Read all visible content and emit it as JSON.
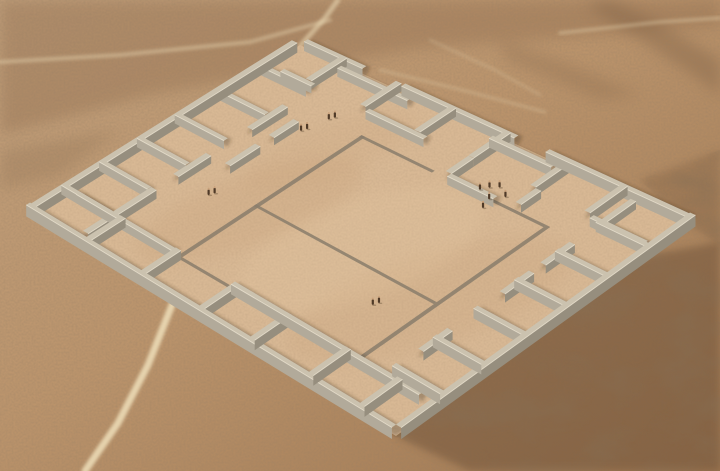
{
  "image": {
    "width": 720,
    "height": 471,
    "description": "Aerial 3D reconstruction of a large square walled archaeological compound (adobe enclosure) on a desert plain: perimeter rooms along all four sides, a flat-outlined central courtyard, tiny human figures for scale, and light foot tracks crossing the sand."
  },
  "colors": {
    "bg1": "#c2a17d",
    "bg2": "#bb946c",
    "bg3": "#9e7650",
    "topBand": "#8f6b4b",
    "rough": "#6e5137",
    "sand": "#d9b995",
    "sandShade": "#c19870",
    "sandLight": "#e8cca6",
    "path": "#efdfba",
    "wallTop": "#cbc2af",
    "wallLight": "#b2aa9a",
    "wallDark": "#968e7e",
    "wallHighlight": "#e9e1cf",
    "strip": "#8b7e6c",
    "shadow": "#3c2a18",
    "figure": "#4f3a28",
    "figureHead": "#caa27c"
  },
  "desert": {
    "top_band": [
      [
        0,
        0
      ],
      [
        720,
        0
      ],
      [
        720,
        26
      ],
      [
        420,
        48
      ],
      [
        150,
        95
      ],
      [
        0,
        135
      ]
    ],
    "rough_patches": [
      {
        "pts": [
          [
            720,
            242
          ],
          [
            622,
            260
          ],
          [
            520,
            300
          ],
          [
            430,
            390
          ],
          [
            396,
            436
          ],
          [
            470,
            471
          ],
          [
            720,
            471
          ]
        ],
        "opacity": 0.5
      },
      {
        "pts": [
          [
            720,
            150
          ],
          [
            640,
            180
          ],
          [
            688,
            224
          ],
          [
            720,
            245
          ]
        ],
        "opacity": 0.25
      }
    ],
    "streaks": [
      {
        "pts": [
          [
            585,
            5
          ],
          [
            640,
            40
          ],
          [
            700,
            80
          ],
          [
            720,
            95
          ],
          [
            720,
            60
          ],
          [
            655,
            20
          ],
          [
            610,
            0
          ]
        ],
        "opacity": 0.3
      },
      {
        "pts": [
          [
            500,
            40
          ],
          [
            560,
            60
          ],
          [
            640,
            95
          ],
          [
            600,
            100
          ],
          [
            505,
            60
          ]
        ],
        "opacity": 0.2
      },
      {
        "pts": [
          [
            0,
            150
          ],
          [
            120,
            130
          ],
          [
            60,
            175
          ],
          [
            0,
            190
          ]
        ],
        "opacity": 0.18
      }
    ],
    "tracks": [
      {
        "pts": [
          [
            85,
            471
          ],
          [
            118,
            423
          ],
          [
            148,
            365
          ],
          [
            172,
            305
          ],
          [
            192,
            262
          ]
        ],
        "w": 7,
        "o": 0.85
      },
      {
        "pts": [
          [
            0,
            62
          ],
          [
            120,
            55
          ],
          [
            250,
            42
          ],
          [
            330,
            20
          ]
        ],
        "w": 4,
        "o": 0.4
      },
      {
        "pts": [
          [
            300,
            46
          ],
          [
            325,
            18
          ],
          [
            338,
            0
          ]
        ],
        "w": 5,
        "o": 0.55
      },
      {
        "pts": [
          [
            560,
            33
          ],
          [
            660,
            22
          ],
          [
            720,
            18
          ]
        ],
        "w": 3.5,
        "o": 0.35
      },
      {
        "pts": [
          [
            380,
            70
          ],
          [
            470,
            92
          ],
          [
            545,
            112
          ]
        ],
        "w": 3,
        "o": 0.25
      },
      {
        "pts": [
          [
            430,
            40
          ],
          [
            495,
            70
          ],
          [
            540,
            95
          ]
        ],
        "w": 3,
        "o": 0.2
      }
    ],
    "floor_blotches": [
      {
        "cx": 250,
        "cy": 210,
        "rx": 120,
        "ry": 35,
        "rot": -20,
        "fill": "sandShade",
        "o": 0.18
      },
      {
        "cx": 430,
        "cy": 300,
        "rx": 150,
        "ry": 45,
        "rot": -18,
        "fill": "sandShade",
        "o": 0.15
      },
      {
        "cx": 330,
        "cy": 150,
        "rx": 90,
        "ry": 25,
        "rot": -20,
        "fill": "sandShade",
        "o": 0.12
      },
      {
        "cx": 360,
        "cy": 250,
        "rx": 130,
        "ry": 50,
        "rot": -19,
        "fill": "sandLight",
        "o": 0.2
      }
    ]
  },
  "compound": {
    "corners": {
      "w": [
        30,
        214
      ],
      "n": [
        300,
        45
      ],
      "s": [
        396,
        436
      ],
      "e": [
        690,
        224
      ]
    },
    "wallHeight": 10,
    "thickness": 0.014,
    "walls": [
      {
        "a": [
          0,
          0
        ],
        "b": [
          0.97,
          0
        ],
        "h": 11,
        "n": "perimeter-wall-nw"
      },
      {
        "a": [
          0,
          0
        ],
        "b": [
          0,
          1
        ],
        "h": 11,
        "n": "perimeter-wall-sw"
      },
      {
        "a": [
          0,
          1
        ],
        "b": [
          1,
          1
        ],
        "h": 11,
        "n": "perimeter-wall-se"
      },
      {
        "a": [
          1,
          0.02
        ],
        "b": [
          1,
          0.17
        ],
        "h": 11,
        "n": "perimeter-wall-ne"
      },
      {
        "a": [
          0.965,
          0.13
        ],
        "b": [
          0.965,
          0.31
        ],
        "h": 10,
        "n": "perimeter-wall-ne"
      },
      {
        "a": [
          1,
          0.27
        ],
        "b": [
          1,
          0.56
        ],
        "h": 11,
        "n": "perimeter-wall-ne"
      },
      {
        "a": [
          0.965,
          0.52
        ],
        "b": [
          0.965,
          0.68
        ],
        "h": 10,
        "n": "perimeter-wall-ne"
      },
      {
        "a": [
          1,
          0.64
        ],
        "b": [
          1,
          1
        ],
        "h": 11,
        "n": "perimeter-wall-ne"
      },
      {
        "a": [
          0.13,
          0
        ],
        "b": [
          0.13,
          0.13
        ],
        "h": 9.5
      },
      {
        "a": [
          0.27,
          0
        ],
        "b": [
          0.27,
          0.13
        ],
        "h": 9.5
      },
      {
        "a": [
          0.41,
          0
        ],
        "b": [
          0.41,
          0.13
        ],
        "h": 9.5
      },
      {
        "a": [
          0.55,
          0
        ],
        "b": [
          0.55,
          0.13
        ],
        "h": 9.5
      },
      {
        "a": [
          0.7,
          0
        ],
        "b": [
          0.7,
          0.13
        ],
        "h": 9.5
      },
      {
        "a": [
          0.85,
          0
        ],
        "b": [
          0.85,
          0.13
        ],
        "h": 9.5
      },
      {
        "a": [
          0.02,
          0.13
        ],
        "b": [
          0.27,
          0.13
        ],
        "h": 9
      },
      {
        "a": [
          0.35,
          0.13
        ],
        "b": [
          0.47,
          0.13
        ],
        "h": 8.5
      },
      {
        "a": [
          0.62,
          0.13
        ],
        "b": [
          0.75,
          0.13
        ],
        "h": 8.5
      },
      {
        "a": [
          0,
          0.15
        ],
        "b": [
          0.13,
          0.15
        ],
        "h": 9.5
      },
      {
        "a": [
          0,
          0.3
        ],
        "b": [
          0.13,
          0.3
        ],
        "h": 9.5
      },
      {
        "a": [
          0,
          0.46
        ],
        "b": [
          0.13,
          0.46
        ],
        "h": 9.5
      },
      {
        "a": [
          0,
          0.6
        ],
        "b": [
          0.13,
          0.6
        ],
        "h": 9.5
      },
      {
        "a": [
          0,
          0.76
        ],
        "b": [
          0.13,
          0.76
        ],
        "h": 9.5
      },
      {
        "a": [
          0,
          0.9
        ],
        "b": [
          0.13,
          0.9
        ],
        "h": 9.5
      },
      {
        "a": [
          0.13,
          0.04
        ],
        "b": [
          0.13,
          0.3
        ],
        "h": 9
      },
      {
        "a": [
          0.13,
          0.46
        ],
        "b": [
          0.13,
          0.97
        ],
        "h": 9.5
      },
      {
        "a": [
          0.15,
          1
        ],
        "b": [
          0.15,
          0.87
        ],
        "h": 9.5
      },
      {
        "a": [
          0.29,
          1
        ],
        "b": [
          0.29,
          0.87
        ],
        "h": 9.5
      },
      {
        "a": [
          0.43,
          1
        ],
        "b": [
          0.43,
          0.87
        ],
        "h": 9.5
      },
      {
        "a": [
          0.57,
          1
        ],
        "b": [
          0.57,
          0.87
        ],
        "h": 9.5
      },
      {
        "a": [
          0.71,
          1
        ],
        "b": [
          0.71,
          0.87
        ],
        "h": 9.5
      },
      {
        "a": [
          0.85,
          1
        ],
        "b": [
          0.85,
          0.87
        ],
        "h": 9.5
      },
      {
        "a": [
          0.24,
          0.87
        ],
        "b": [
          0.34,
          0.87
        ],
        "h": 8.5
      },
      {
        "a": [
          0.52,
          0.87
        ],
        "b": [
          0.62,
          0.87
        ],
        "h": 8.5
      },
      {
        "a": [
          0.66,
          0.87
        ],
        "b": [
          0.76,
          0.87
        ],
        "h": 8.5
      },
      {
        "a": [
          0.86,
          0.87
        ],
        "b": [
          0.97,
          0.87
        ],
        "h": 8.5
      },
      {
        "a": [
          1,
          0.12
        ],
        "b": [
          0.87,
          0.12
        ],
        "h": 9.5
      },
      {
        "a": [
          1,
          0.26
        ],
        "b": [
          0.87,
          0.26
        ],
        "h": 9.5
      },
      {
        "a": [
          1,
          0.4
        ],
        "b": [
          0.87,
          0.4
        ],
        "h": 9.5
      },
      {
        "a": [
          1,
          0.54
        ],
        "b": [
          0.87,
          0.54
        ],
        "h": 9.5
      },
      {
        "a": [
          1,
          0.7
        ],
        "b": [
          0.87,
          0.7
        ],
        "h": 9.5
      },
      {
        "a": [
          1,
          0.84
        ],
        "b": [
          0.87,
          0.84
        ],
        "h": 9.5
      },
      {
        "a": [
          0.87,
          0.27
        ],
        "b": [
          0.87,
          0.42
        ],
        "h": 9
      },
      {
        "a": [
          0.87,
          0.85
        ],
        "b": [
          0.87,
          0.99
        ],
        "h": 9
      },
      {
        "a": [
          0.87,
          0.05
        ],
        "b": [
          0.87,
          0.13
        ],
        "h": 8.5
      },
      {
        "a": [
          0.87,
          0.54
        ],
        "b": [
          0.79,
          0.54
        ],
        "h": 9
      },
      {
        "a": [
          0.79,
          0.54
        ],
        "b": [
          0.79,
          0.66
        ],
        "h": 9
      },
      {
        "a": [
          0.8,
          0.7
        ],
        "b": [
          0.87,
          0.7
        ],
        "h": 8.5
      },
      {
        "a": [
          0.47,
          0.18
        ],
        "b": [
          0.58,
          0.18
        ],
        "h": 8.5
      },
      {
        "a": [
          0.63,
          0.18
        ],
        "b": [
          0.72,
          0.18
        ],
        "h": 8.5
      }
    ],
    "courtyard": {
      "stripWidth": 0.01,
      "strips": [
        {
          "a": [
            0.14,
            0.3
          ],
          "b": [
            0.8,
            0.3
          ]
        },
        {
          "a": [
            0.8,
            0.3
          ],
          "b": [
            0.8,
            0.49
          ]
        },
        {
          "a": [
            0.8,
            0.575
          ],
          "b": [
            0.8,
            0.78
          ]
        },
        {
          "a": [
            0.14,
            0.78
          ],
          "b": [
            0.8,
            0.78
          ]
        },
        {
          "a": [
            0.14,
            0.3
          ],
          "b": [
            0.14,
            0.78
          ]
        },
        {
          "a": [
            0.42,
            0.3
          ],
          "b": [
            0.42,
            0.78
          ]
        }
      ]
    },
    "figures": [
      [
        0.37,
        0.21
      ],
      [
        0.385,
        0.215
      ],
      [
        0.72,
        0.2
      ],
      [
        0.735,
        0.205
      ],
      [
        0.8,
        0.215
      ],
      [
        0.815,
        0.22
      ],
      [
        0.315,
        0.69
      ],
      [
        0.33,
        0.695
      ],
      [
        0.81,
        0.6
      ],
      [
        0.83,
        0.61
      ],
      [
        0.845,
        0.625
      ],
      [
        0.795,
        0.635
      ],
      [
        0.825,
        0.655
      ],
      [
        0.76,
        0.645
      ]
    ]
  }
}
